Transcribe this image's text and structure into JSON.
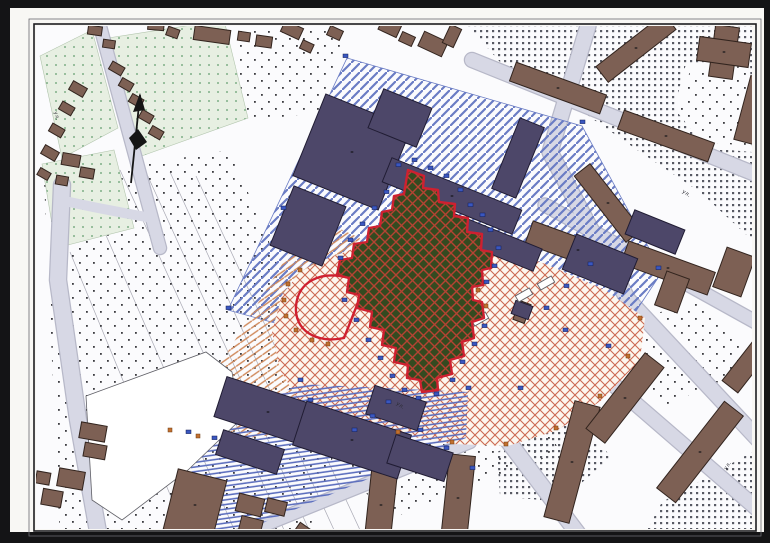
{
  "street_labels": [
    {
      "text": "ул."
    },
    {
      "text": "ул."
    },
    {
      "text": "ул."
    },
    {
      "text": "ул."
    }
  ],
  "palette": {
    "frame": "#141416",
    "margin": "#f8f7f4",
    "neatline": "#1d1d20",
    "neatline_outer": "#6a6a70",
    "map_bg": "#fbfbfd",
    "street": "#d7d8e5",
    "street_edge": "#b7b8c8",
    "parcel_green": "#e7efe2",
    "parcel_green_dot": "#7fae86",
    "parcel_line": "#a9a9b4",
    "building_brown": "#7d6054",
    "building_brown_edge": "#32241e",
    "building_navy": "#4d4769",
    "building_navy_edge": "#201c33",
    "building_darkred": "#7a4034",
    "building_darkred_hatch": "#3c1f18",
    "white_bld": "#ffffff",
    "bld_outline": "#5f5f66",
    "hatch_blue": "#6a7cc4",
    "stripe_blue": "#5d6fbe",
    "hatch_orange": "#d08a5c",
    "crosshatch_red": "#cc6a52",
    "blob_bg": "#fdf7ef",
    "site_green": "#344a20",
    "site_grid": "#b64333",
    "boundary_red": "#cf2030",
    "dot_grid": "#585a64",
    "sparse_dot": "#3c3c40",
    "marker_blue": "#3a57c0",
    "marker_blue_edge": "#141f55",
    "marker_orange": "#c2702f",
    "marker_orange_edge": "#6e3c12",
    "compass": "#151515",
    "label_ink": "#2c2c34"
  }
}
